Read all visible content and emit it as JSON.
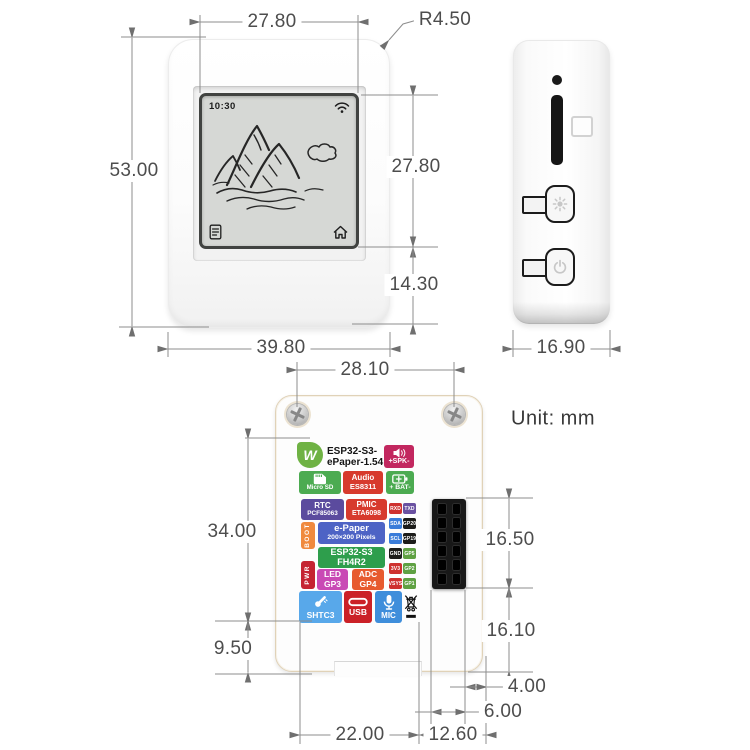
{
  "unit_label": "Unit: mm",
  "front_view": {
    "screen": {
      "time": "10:30"
    },
    "dims": {
      "screen_width": "27.80",
      "corner_radius": "R4.50",
      "height": "53.00",
      "screen_height": "27.80",
      "screen_to_bottom": "14.30",
      "width": "39.80"
    }
  },
  "side_view": {
    "dims": {
      "depth": "16.90"
    }
  },
  "back_view": {
    "dims": {
      "screw_spacing": "28.10",
      "label_area_height": "34.00",
      "label_to_bottom": "9.50",
      "header_height": "16.50",
      "header_to_bottom": "16.10",
      "header_edge_gap": "4.00",
      "header_width": "6.00",
      "notch_left_span": "22.00",
      "notch_right_span": "12.60"
    },
    "sticker": {
      "logo": "W",
      "title_line1": "ESP32-S3-",
      "title_line2": "ePaper-1.54",
      "spk": "+SPK-",
      "micro_sd": "Micro SD",
      "audio_line1": "Audio",
      "audio_line2": "ES8311",
      "bat": "+ BAT-",
      "rtc_line1": "RTC",
      "rtc_line2": "PCF85063",
      "pmic_line1": "PMIC",
      "pmic_line2": "ETA6098",
      "boot": "BOOT",
      "epaper_line1": "e-Paper",
      "epaper_line2": "200×200 Pixels",
      "esp_line1": "ESP32-S3",
      "esp_line2": "FH4R2",
      "pwr": "PWR",
      "led_line1": "LED",
      "led_line2": "GP3",
      "adc_line1": "ADC",
      "adc_line2": "GP4",
      "shtc3": "SHTC3",
      "usb": "USB",
      "mic": "MIC",
      "pins": [
        [
          "RXD",
          "TXD"
        ],
        [
          "SDA",
          "GP20"
        ],
        [
          "SCL",
          "GP19"
        ],
        [
          "GND",
          "GP5"
        ],
        [
          "3V3",
          "GP2"
        ],
        [
          "VSYS",
          "GP1"
        ]
      ]
    }
  },
  "icons": {
    "wifi-icon": "wifi arcs",
    "notes-icon": "note list",
    "home-icon": "house outline",
    "brightness-button-icon": "sun",
    "power-button-icon": "power symbol",
    "speaker-icon": "loudspeaker",
    "sd-card-icon": "sd card",
    "battery-icon": "battery",
    "thermometer-icon": "thermometer",
    "usb-c-icon": "usb-c capsule",
    "microphone-icon": "microphone",
    "weee-icon": "crossed-out bin"
  },
  "palette": {
    "green": "#4cab51",
    "red": "#d73a2d",
    "crimson": "#c2275f",
    "purple": "#5b4b9e",
    "blue": "#4d63c5",
    "esp_green": "#2e9e4c",
    "orange": "#f08a3e",
    "pwr_red": "#c52432",
    "magenta": "#c94ab5",
    "adc_orange": "#e75a2e",
    "shtc_blue": "#58a8ea",
    "usb_red": "#cb2127",
    "mic_blue": "#3f8edb",
    "logo_green": "#6fb244",
    "dim_line": "#8d8d8d",
    "dim_text": "#4d4d4d"
  }
}
